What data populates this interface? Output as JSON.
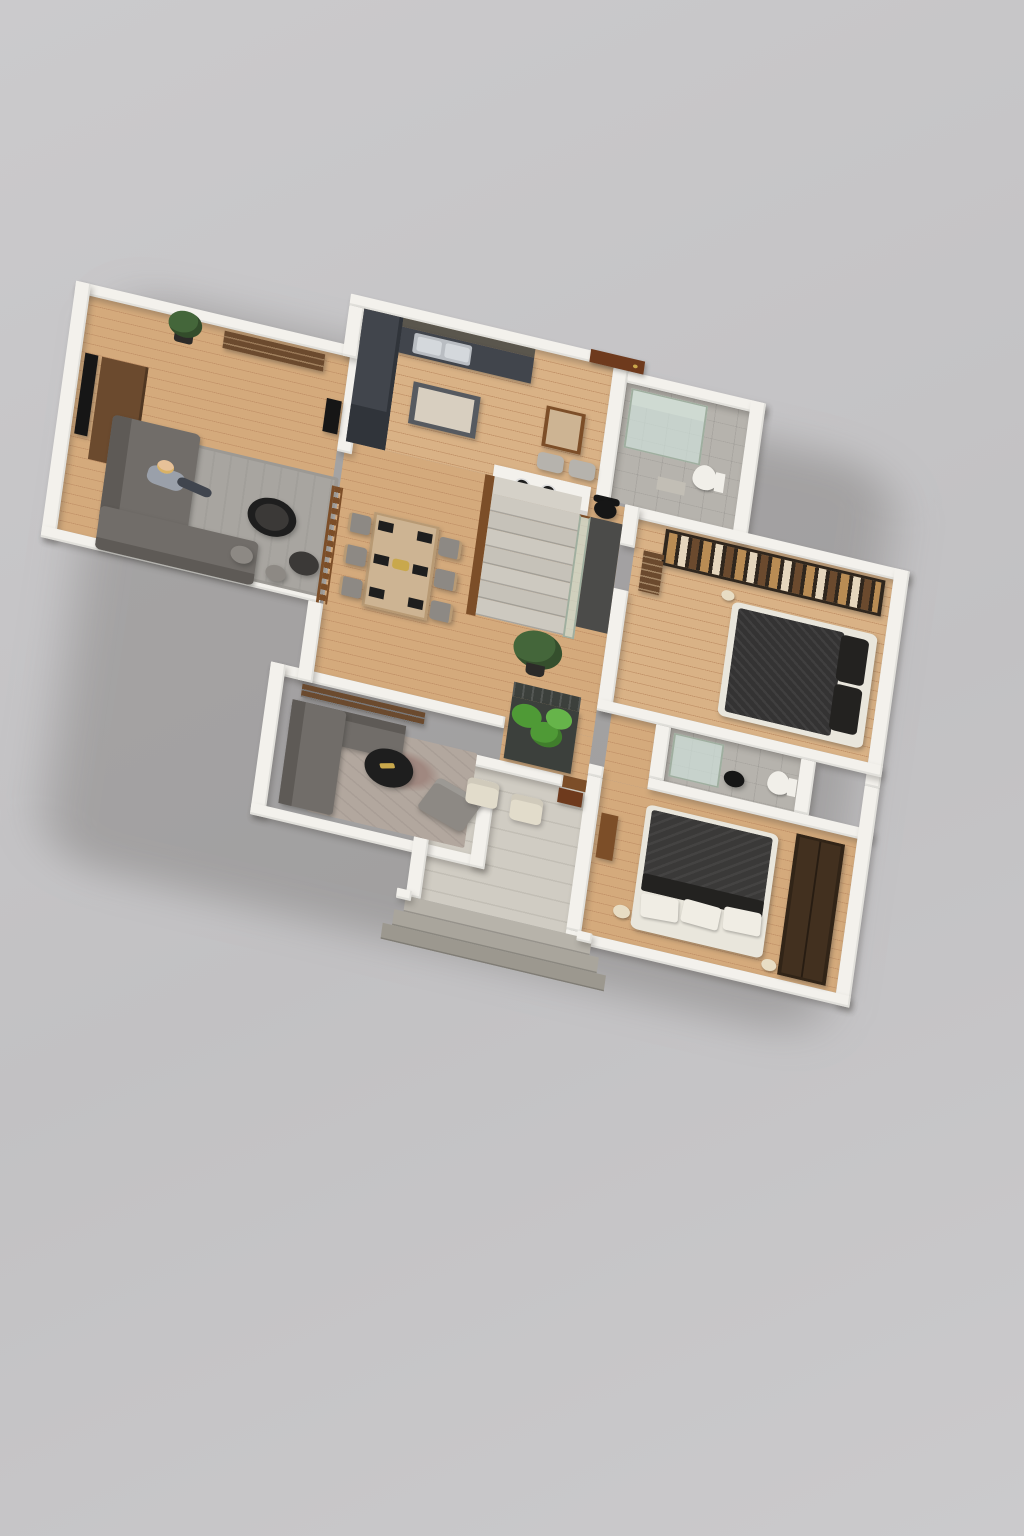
{
  "scene": {
    "type": "isometric-3d-floor-plan-render",
    "backdrop": "plain-light-gray-studio-ground",
    "floors_shown": 1,
    "text_on_image": "none"
  },
  "colors": {
    "ground1": "#cbcacc",
    "ground2": "#c2c1c3",
    "wall": "#f3f1ec",
    "wood": "#d4aa7c",
    "wood2": "#d9b286",
    "woodLine": "#c3946a",
    "tile": "#b6b3ad",
    "concrete": "#d0ccc3",
    "concreteLine": "#c2beb5",
    "step1": "#b7b3aa",
    "step2": "#a9a59c",
    "step3": "#9c988f",
    "counterDark": "#41454c",
    "counterDeep": "#30343a",
    "upperCab": "#5a564d",
    "islandTop": "#d8cfc0",
    "metal": "#b9bdc2",
    "metalLight": "#d4d8dc",
    "sofa": "#716d69",
    "sofaDark": "#5e5a56",
    "rug": "#a8a5a0",
    "rugInner": "#9c9994",
    "rugWarm": "#b2a79e",
    "rugPatch": "#a08880",
    "tableTop": "#cdb493",
    "tableEdge": "#b89a74",
    "chair": "#8d8984",
    "placemat": "#1e1e1e",
    "railWood": "#7c4e28",
    "doorBrown": "#6e3a1d",
    "woodBrown": "#6b4a2e",
    "wardrobe": "#2f261d",
    "clothes1": "#b98c54",
    "clothes2": "#e5d6bd",
    "clothes3": "#6b4a2e",
    "wardrobe2": "#42301f",
    "blanket": "#343333",
    "blanket2": "#3a3938",
    "pillowDark": "#232220",
    "pillow": "#f0ede4",
    "bedFrame": "#e9e6dc",
    "dark": "#161616",
    "voidDark": "#4b4b49",
    "plant": "#44663a",
    "plantBright": "#4f9a36",
    "planterBox": "#3c403c",
    "potDark": "#2c2a28",
    "glass": "#cfe0d8b3",
    "glassFrame": "#9fae9f",
    "skin": "#e7c198",
    "hair": "#d9b266",
    "shirt": "#9aa0aa",
    "shorts": "#40454e",
    "cream": "#e6d9bd",
    "toiletWhite": "#f1efe9",
    "chairCream": "#e2dccb",
    "lamp": "#e8ddc4",
    "gold": "#c9a84c"
  },
  "rooms": [
    {
      "name": "living-room",
      "furniture": [
        "wall-mounted-tv",
        "media-console",
        "corner-sofa",
        "seated-person",
        "area-rug",
        "round-coffee-table",
        "round-coffee-table-small",
        "pouf",
        "pouf",
        "wall-shelf",
        "potted-plant",
        "black-av-panel"
      ]
    },
    {
      "name": "kitchen",
      "furniture": [
        "upper-cabinets",
        "l-shaped-counter",
        "double-sink",
        "kitchen-island",
        "tall-cabinet",
        "breakfast-table",
        "pouf",
        "pouf",
        "cooktop-peninsula",
        "entry-door"
      ]
    },
    {
      "name": "dining-area",
      "furniture": [
        "dining-table",
        "six-dining-chairs",
        "black-placemats",
        "centerpiece",
        "wood-railing"
      ]
    },
    {
      "name": "hallway",
      "furniture": [
        "staircase",
        "glass-balustrade",
        "understair-void",
        "potted-plant",
        "planter-box-with-trellis",
        "office-chair"
      ]
    },
    {
      "name": "bathroom-1",
      "furniture": [
        "glass-shower",
        "toilet",
        "bath-mat"
      ]
    },
    {
      "name": "master-bedroom",
      "furniture": [
        "open-wardrobe-with-clothes",
        "double-bed-dark-bedding",
        "entry-bench",
        "table-lamp"
      ]
    },
    {
      "name": "bathroom-2",
      "furniture": [
        "glass-shower",
        "toilet",
        "black-stool"
      ]
    },
    {
      "name": "bedroom-2",
      "furniture": [
        "double-bed-dark-blanket",
        "white-pillows",
        "tall-wardrobe",
        "bedside-lamp",
        "bedside-lamp",
        "wall-console"
      ]
    },
    {
      "name": "lounge",
      "furniture": [
        "corner-sofa",
        "round-coffee-table",
        "armchair",
        "patterned-rug",
        "sideboard"
      ]
    },
    {
      "name": "entry-porch",
      "furniture": [
        "outdoor-chair",
        "outdoor-chair",
        "shoe-console",
        "wood-sill",
        "three-concrete-steps"
      ]
    }
  ]
}
